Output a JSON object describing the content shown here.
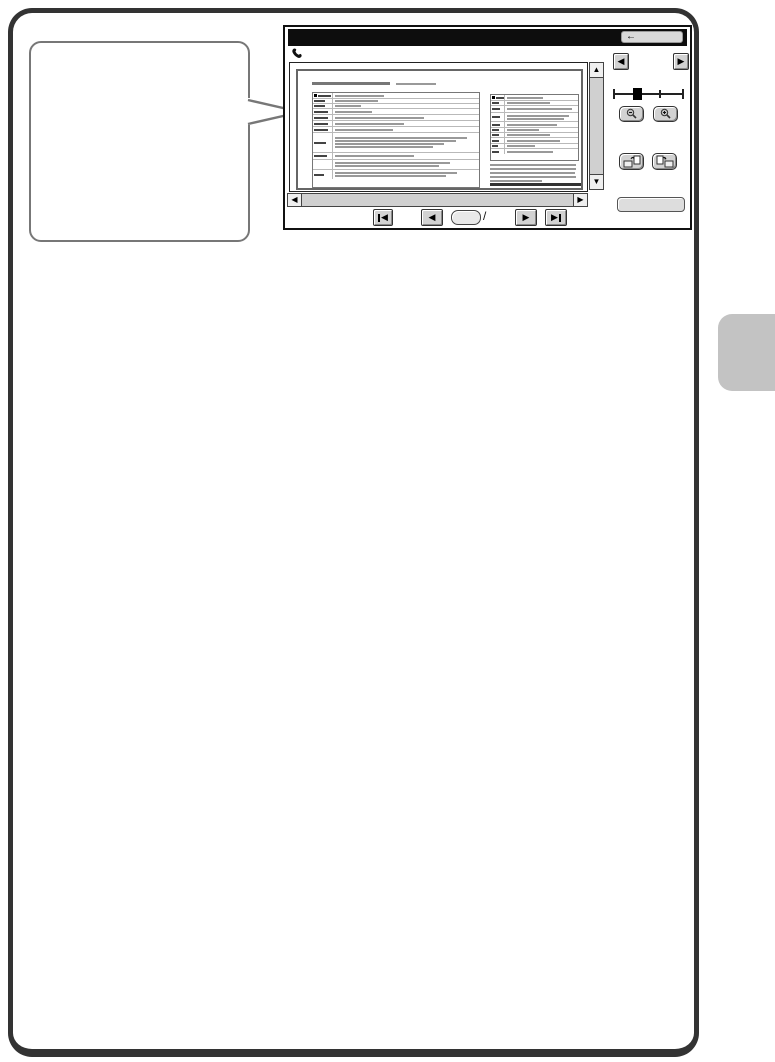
{
  "colors": {
    "page_frame": "#333333",
    "callout_border": "#777777",
    "screenshot_border": "#111111",
    "titlebar": "#0d0d0d",
    "button_face": "#d2d2d2",
    "scroll_track": "#d0d0d0",
    "side_tab": "#c3c3c3",
    "slider_thumb": "#000000"
  },
  "callout": {
    "text": ""
  },
  "side_tab": {
    "label": ""
  },
  "screenshot": {
    "titlebar": {
      "title": "",
      "back_button": {
        "glyph": "←",
        "label": ""
      }
    },
    "phone_icon": "phone-receiver",
    "preview": {
      "vscroll": {
        "up": "▲",
        "down": "▼"
      },
      "hscroll": {
        "left": "◀",
        "right": "▶"
      }
    },
    "panel": {
      "page_left": {
        "glyph": "◀"
      },
      "page_right": {
        "glyph": "▶"
      },
      "zoom_slider": {
        "thumb_percent": 34,
        "mid_tick_percent": 66
      },
      "zoom_out": {
        "icon": "magnifier-minus-icon",
        "label": ""
      },
      "zoom_in": {
        "icon": "magnifier-plus-icon",
        "label": ""
      },
      "rotate_left": {
        "icon": "rotate-page-left-icon",
        "label": ""
      },
      "rotate_right": {
        "icon": "rotate-page-right-icon",
        "label": ""
      },
      "action_button": {
        "label": ""
      }
    },
    "pagination": {
      "first_glyph": "◀",
      "prev_glyph": "◀",
      "page_value": "",
      "separator": "/",
      "total_value": "",
      "next_glyph": "▶",
      "last_glyph": "▶"
    },
    "document": {
      "title_bars": [
        78,
        40
      ],
      "left_rows": [
        {
          "h": 6,
          "lw": 70,
          "vw": 34,
          "lines": 1,
          "hdr": true
        },
        {
          "h": 5,
          "lw": 60,
          "vw": 30,
          "lines": 1
        },
        {
          "h": 5,
          "lw": 60,
          "vw": 18,
          "lines": 1
        },
        {
          "h": 6,
          "lw": 75,
          "vw": 26,
          "lines": 1
        },
        {
          "h": 6,
          "lw": 75,
          "vw": 62,
          "lines": 1
        },
        {
          "h": 6,
          "lw": 75,
          "vw": 48,
          "lines": 1
        },
        {
          "h": 6,
          "lw": 75,
          "vw": 40,
          "lines": 1
        },
        {
          "h": 20,
          "lw": 65,
          "vw": 92,
          "lines": 4
        },
        {
          "h": 7,
          "lw": 70,
          "vw": 55,
          "lines": 1
        },
        {
          "h": 10,
          "lw": 0,
          "vw": 80,
          "lines": 2
        },
        {
          "h": 9,
          "lw": 55,
          "vw": 85,
          "lines": 2
        }
      ],
      "right_rows": [
        {
          "h": 6,
          "lw": 70,
          "vw": 50,
          "lines": 1,
          "hdr": true
        },
        {
          "h": 5,
          "lw": 55,
          "vw": 60,
          "lines": 1
        },
        {
          "h": 7,
          "lw": 70,
          "vw": 92,
          "lines": 1
        },
        {
          "h": 9,
          "lw": 65,
          "vw": 88,
          "lines": 2
        },
        {
          "h": 6,
          "lw": 70,
          "vw": 70,
          "lines": 1
        },
        {
          "h": 5,
          "lw": 55,
          "vw": 45,
          "lines": 1
        },
        {
          "h": 5,
          "lw": 60,
          "vw": 60,
          "lines": 1
        },
        {
          "h": 6,
          "lw": 55,
          "vw": 75,
          "lines": 1
        },
        {
          "h": 5,
          "lw": 50,
          "vw": 40,
          "lines": 1
        },
        {
          "h": 5,
          "lw": 55,
          "vw": 65,
          "lines": 1
        }
      ],
      "paragraph_widths": [
        97,
        97,
        96,
        97,
        58
      ],
      "footer_bar_width": 55
    }
  }
}
